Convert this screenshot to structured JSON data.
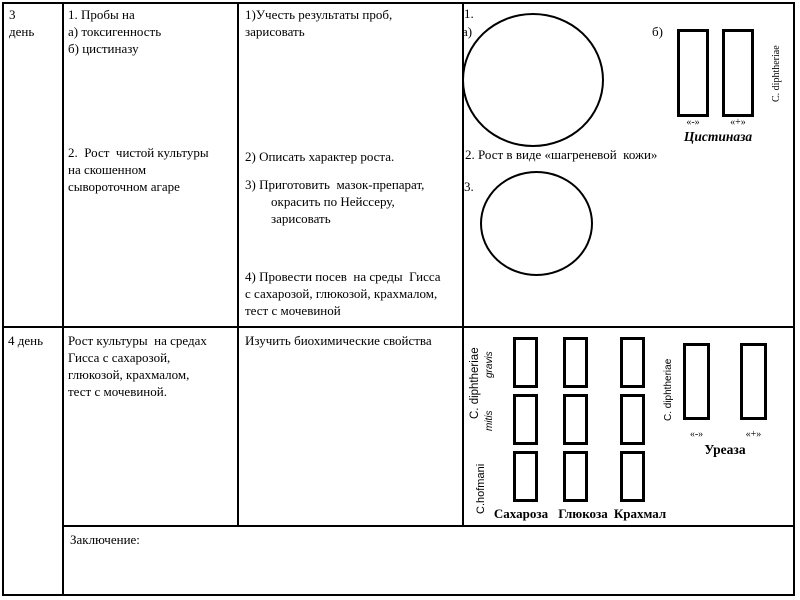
{
  "row1": {
    "day": "3\nдень",
    "tests1": "1. Пробы на\nа) токсигенность\nб) цистиназу",
    "tests2": "2.  Рост  чистой культуры\nна скошенном\nсывороточном агаре",
    "action1": "1)Учесть результаты проб,\nзарисовать",
    "action2": "2) Описать характер роста.",
    "action3": "3) Приготовить  мазок-препарат,\n        окрасить по Нейссеру,\n        зарисовать",
    "action4": "4) Провести посев  на среды  Гисса\nс сахарозой, глюкозой, крахмалом,\nтест с мочевиной",
    "results": {
      "num1": "1.",
      "label_a": "а)",
      "label_b": "б)",
      "neg": "«-»",
      "pos": "«+»",
      "cystinase_title": "Цистиназа",
      "species": "C. diphtheriae",
      "growth_note": "2. Рост в виде «шагреневой  кожи»",
      "num3": "3."
    }
  },
  "row2": {
    "day": "4 день",
    "task": "Рост культуры  на средах\nГисса с сахарозой,\nглюкозой, крахмалом,\nтест с мочевиной.",
    "action": "Изучить биохимические свойства",
    "sugars": {
      "species_main": "C. diphtheriae",
      "biotype_gravis": "gravis",
      "biotype_mitis": "mitis",
      "species_hofmani": "C.hofmani",
      "col_labels": [
        "Сахароза",
        "Глюкоза",
        "Крахмал"
      ]
    },
    "urease": {
      "species": "C. diphtheriae",
      "neg": "«-»",
      "pos": "«+»",
      "title": "Уреаза"
    }
  },
  "footer": {
    "conclusion": "Заключение:"
  }
}
